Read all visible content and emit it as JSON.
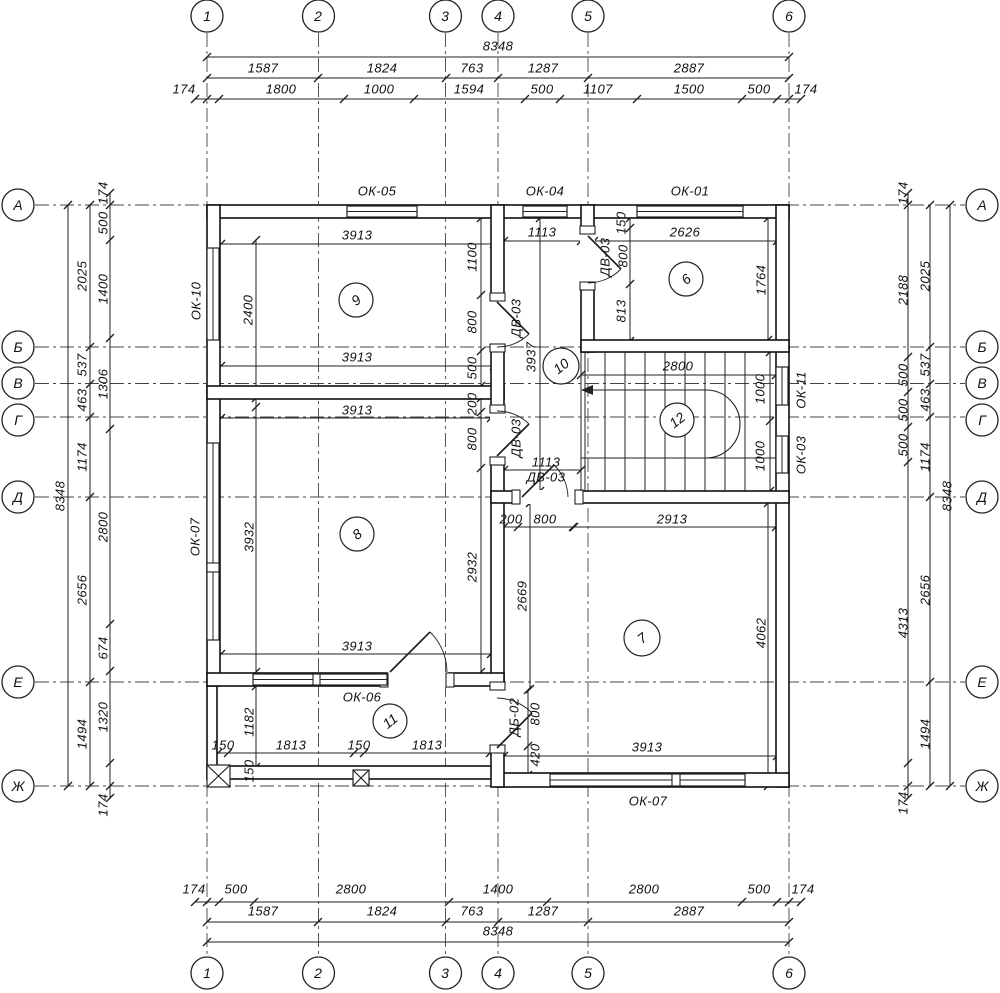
{
  "axes": {
    "cols": [
      "1",
      "2",
      "3",
      "4",
      "5",
      "6"
    ],
    "rows": [
      "А",
      "Б",
      "В",
      "Г",
      "Д",
      "Е",
      "Ж"
    ]
  },
  "dims_top": {
    "total": "8348",
    "row2": [
      "1587",
      "1824",
      "763",
      "1287",
      "2887"
    ],
    "row3": [
      "174",
      "1800",
      "1000",
      "1594",
      "500",
      "1107",
      "1500",
      "500",
      "174"
    ]
  },
  "dims_bottom": {
    "row1": [
      "174",
      "500",
      "2800",
      "1400",
      "2800",
      "500",
      "174"
    ],
    "row2": [
      "1587",
      "1824",
      "763",
      "1287",
      "2887"
    ],
    "total": "8348"
  },
  "dims_left": {
    "total": "8348",
    "axis_col": [
      "2025",
      "537",
      "463",
      "1174",
      "2656",
      "1494"
    ],
    "inner_col": [
      "174",
      "500",
      "1400",
      "1306",
      "2800",
      "674",
      "1320",
      "174"
    ]
  },
  "dims_right": {
    "total": "8348",
    "axis_col": [
      "2025",
      "537",
      "463",
      "1174",
      "2656",
      "1494"
    ],
    "inner_col": [
      "174",
      "2188",
      "500",
      "500",
      "500",
      "4313",
      "174"
    ]
  },
  "windows": {
    "ok05": "ОК-05",
    "ok04": "ОК-04",
    "ok01": "ОК-01",
    "ok10": "ОК-10",
    "ok07_left": "ОК-07",
    "ok11": "ОК-11",
    "ok03": "ОК-03",
    "ok06": "ОК-06",
    "ok07_bottom": "ОК-07"
  },
  "doors": {
    "dv03": "ДВ-03",
    "db02": "ДБ-02"
  },
  "rooms": {
    "r6": "6",
    "r7": "7",
    "r8": "8",
    "r9": "9",
    "r10": "10",
    "r11": "11",
    "r12": "12"
  },
  "interior": {
    "room9_top": "3913",
    "room9_left": "2400",
    "room9_bottom": "3913",
    "wall_col": [
      "1100",
      "800",
      "500",
      "200",
      "800",
      "2932"
    ],
    "corr_top": "1113",
    "corr_len": "3937",
    "corr_mid": "1113",
    "corr_bottom": [
      "200",
      "800"
    ],
    "room6_top": "2626",
    "room6_right": "1764",
    "room6_col": [
      "150",
      "800",
      "813"
    ],
    "stair_top": "2800",
    "stair_right": [
      "1000",
      "1000"
    ],
    "room7_top": "2913",
    "room7_left": "2669",
    "room7_right": "4062",
    "room7_bottom": "3913",
    "room8_top": "3913",
    "room8_left": "3932",
    "room8_bottom": "3913",
    "ver_left": "1182",
    "ver_bottom": [
      "150",
      "1813",
      "150",
      "1813"
    ],
    "ver_corner": "150",
    "db02_col": [
      "800",
      "420"
    ]
  }
}
